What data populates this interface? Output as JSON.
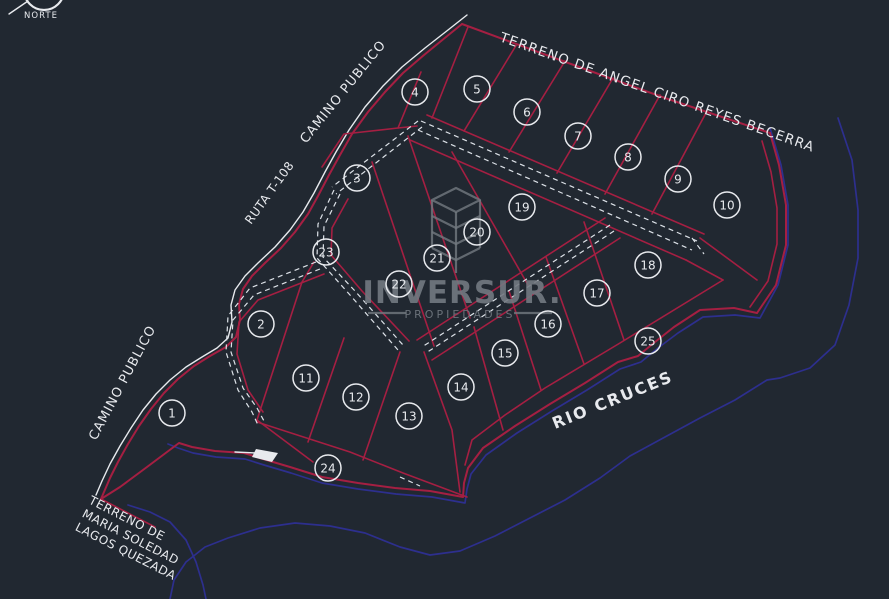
{
  "canvas": {
    "width": 889,
    "height": 599,
    "background": "#212831"
  },
  "colors": {
    "lot_line": "#a51f42",
    "road_line": "#e8eaee",
    "dashed_road": "#dde2e8",
    "river": "#2d2f8e",
    "label_text": "#edeff3",
    "logo_gray": "#737981"
  },
  "north_arrow": {
    "label": "NORTE"
  },
  "watermark": {
    "name": "INVERSUR.",
    "tagline": "PROPIEDADES"
  },
  "labels": [
    {
      "id": "terreno-norte",
      "text": "TERRENO DE ANGEL CIRO REYES BECERRA",
      "x": 499,
      "y": 41,
      "rotate": 19.5,
      "size": 13.5,
      "spacing": 1.2,
      "bold": false
    },
    {
      "id": "camino-publico-norte",
      "text": "CAMINO PUBLICO",
      "x": 306,
      "y": 144,
      "rotate": -51,
      "size": 13,
      "spacing": 1,
      "bold": false
    },
    {
      "id": "ruta-t-108",
      "text": "RUTA T-108",
      "x": 251,
      "y": 225,
      "rotate": -54,
      "size": 12,
      "spacing": 0.5,
      "bold": false
    },
    {
      "id": "camino-publico-sur",
      "text": "CAMINO PUBLICO",
      "x": 96,
      "y": 441,
      "rotate": -62,
      "size": 13,
      "spacing": 1,
      "bold": false
    },
    {
      "id": "rio-cruces",
      "text": "RIO  CRUCES",
      "x": 555,
      "y": 429,
      "rotate": -22,
      "size": 16,
      "spacing": 2,
      "bold": true
    },
    {
      "id": "terreno-sur",
      "lines": [
        "TERRENO DE",
        "MARIA SOLEDAD",
        "LAGOS QUEZADA"
      ],
      "x": 88,
      "y": 503,
      "rotate": 27,
      "size": 12,
      "spacing": 0.5,
      "line_height": 15,
      "bold": false
    }
  ],
  "lots": [
    {
      "n": "1",
      "x": 172,
      "y": 413
    },
    {
      "n": "2",
      "x": 261,
      "y": 324
    },
    {
      "n": "3",
      "x": 357,
      "y": 178
    },
    {
      "n": "4",
      "x": 415,
      "y": 92
    },
    {
      "n": "5",
      "x": 477,
      "y": 89
    },
    {
      "n": "6",
      "x": 527,
      "y": 112
    },
    {
      "n": "7",
      "x": 578,
      "y": 136
    },
    {
      "n": "8",
      "x": 628,
      "y": 157
    },
    {
      "n": "9",
      "x": 678,
      "y": 179
    },
    {
      "n": "10",
      "x": 727,
      "y": 205
    },
    {
      "n": "11",
      "x": 306,
      "y": 378
    },
    {
      "n": "12",
      "x": 356,
      "y": 397
    },
    {
      "n": "13",
      "x": 409,
      "y": 416
    },
    {
      "n": "14",
      "x": 461,
      "y": 387
    },
    {
      "n": "15",
      "x": 505,
      "y": 353
    },
    {
      "n": "16",
      "x": 548,
      "y": 324
    },
    {
      "n": "17",
      "x": 597,
      "y": 293
    },
    {
      "n": "18",
      "x": 648,
      "y": 265
    },
    {
      "n": "19",
      "x": 522,
      "y": 207
    },
    {
      "n": "20",
      "x": 477,
      "y": 232
    },
    {
      "n": "21",
      "x": 437,
      "y": 258
    },
    {
      "n": "22",
      "x": 399,
      "y": 284
    },
    {
      "n": "23",
      "x": 326,
      "y": 252
    },
    {
      "n": "24",
      "x": 328,
      "y": 468
    },
    {
      "n": "25",
      "x": 648,
      "y": 341
    }
  ]
}
